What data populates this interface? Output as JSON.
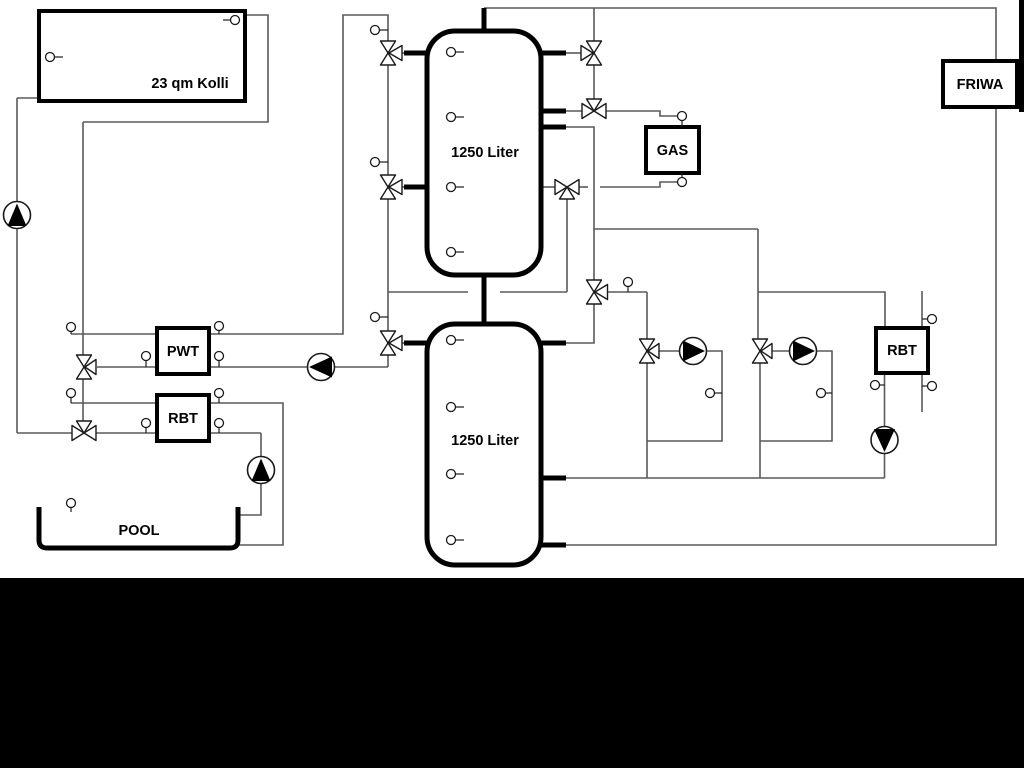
{
  "canvas": {
    "width": 1024,
    "height": 768,
    "background": "#ffffff"
  },
  "colors": {
    "pipe_gray": "#5a5a5a",
    "symbol_outline": "#1a1a1a",
    "component_outline": "#000000",
    "text": "#000000",
    "mask_black": "#000000"
  },
  "labels": {
    "collector": "23 qm Kolli",
    "tank_upper": "1250 Liter",
    "tank_lower": "1250 Liter",
    "pwt": "PWT",
    "rbt_left": "RBT",
    "rbt_right": "RBT",
    "gas": "GAS",
    "friwa": "FRIWA",
    "pool": "POOL"
  },
  "components": {
    "boxes": [
      {
        "name": "solar-collector",
        "label": "23 qm Kolli"
      },
      {
        "name": "buffer-tank-upper",
        "label": "1250 Liter"
      },
      {
        "name": "buffer-tank-lower",
        "label": "1250 Liter"
      },
      {
        "name": "heat-exchanger-pwt",
        "label": "PWT"
      },
      {
        "name": "heat-exchanger-rbt-left",
        "label": "RBT"
      },
      {
        "name": "heat-exchanger-rbt-right",
        "label": "RBT"
      },
      {
        "name": "gas-boiler",
        "label": "GAS"
      },
      {
        "name": "fresh-water-station",
        "label": "FRIWA"
      },
      {
        "name": "swimming-pool",
        "label": "POOL"
      }
    ],
    "pumps": [
      {
        "name": "pump-solar",
        "direction": "up"
      },
      {
        "name": "pump-pwt",
        "direction": "left"
      },
      {
        "name": "pump-pool",
        "direction": "up"
      },
      {
        "name": "pump-heating-1",
        "direction": "right"
      },
      {
        "name": "pump-heating-2",
        "direction": "right"
      },
      {
        "name": "pump-rbt-right",
        "direction": "down"
      }
    ],
    "valves": [
      {
        "name": "three-way-valve-tank-top-left",
        "type": "3-way"
      },
      {
        "name": "three-way-valve-tank-mid-left",
        "type": "3-way"
      },
      {
        "name": "three-way-valve-tank-lower-left",
        "type": "3-way"
      },
      {
        "name": "three-way-valve-gas-top",
        "type": "3-way"
      },
      {
        "name": "three-way-valve-gas-mid",
        "type": "3-way"
      },
      {
        "name": "three-way-valve-gas-bottom",
        "type": "3-way"
      },
      {
        "name": "three-way-valve-distribution",
        "type": "3-way"
      },
      {
        "name": "three-way-valve-pwt",
        "type": "3-way"
      },
      {
        "name": "three-way-valve-pool",
        "type": "3-way"
      },
      {
        "name": "three-way-valve-heating-1",
        "type": "3-way"
      },
      {
        "name": "three-way-valve-heating-2",
        "type": "3-way"
      }
    ],
    "sensor_ports_count": 30
  }
}
